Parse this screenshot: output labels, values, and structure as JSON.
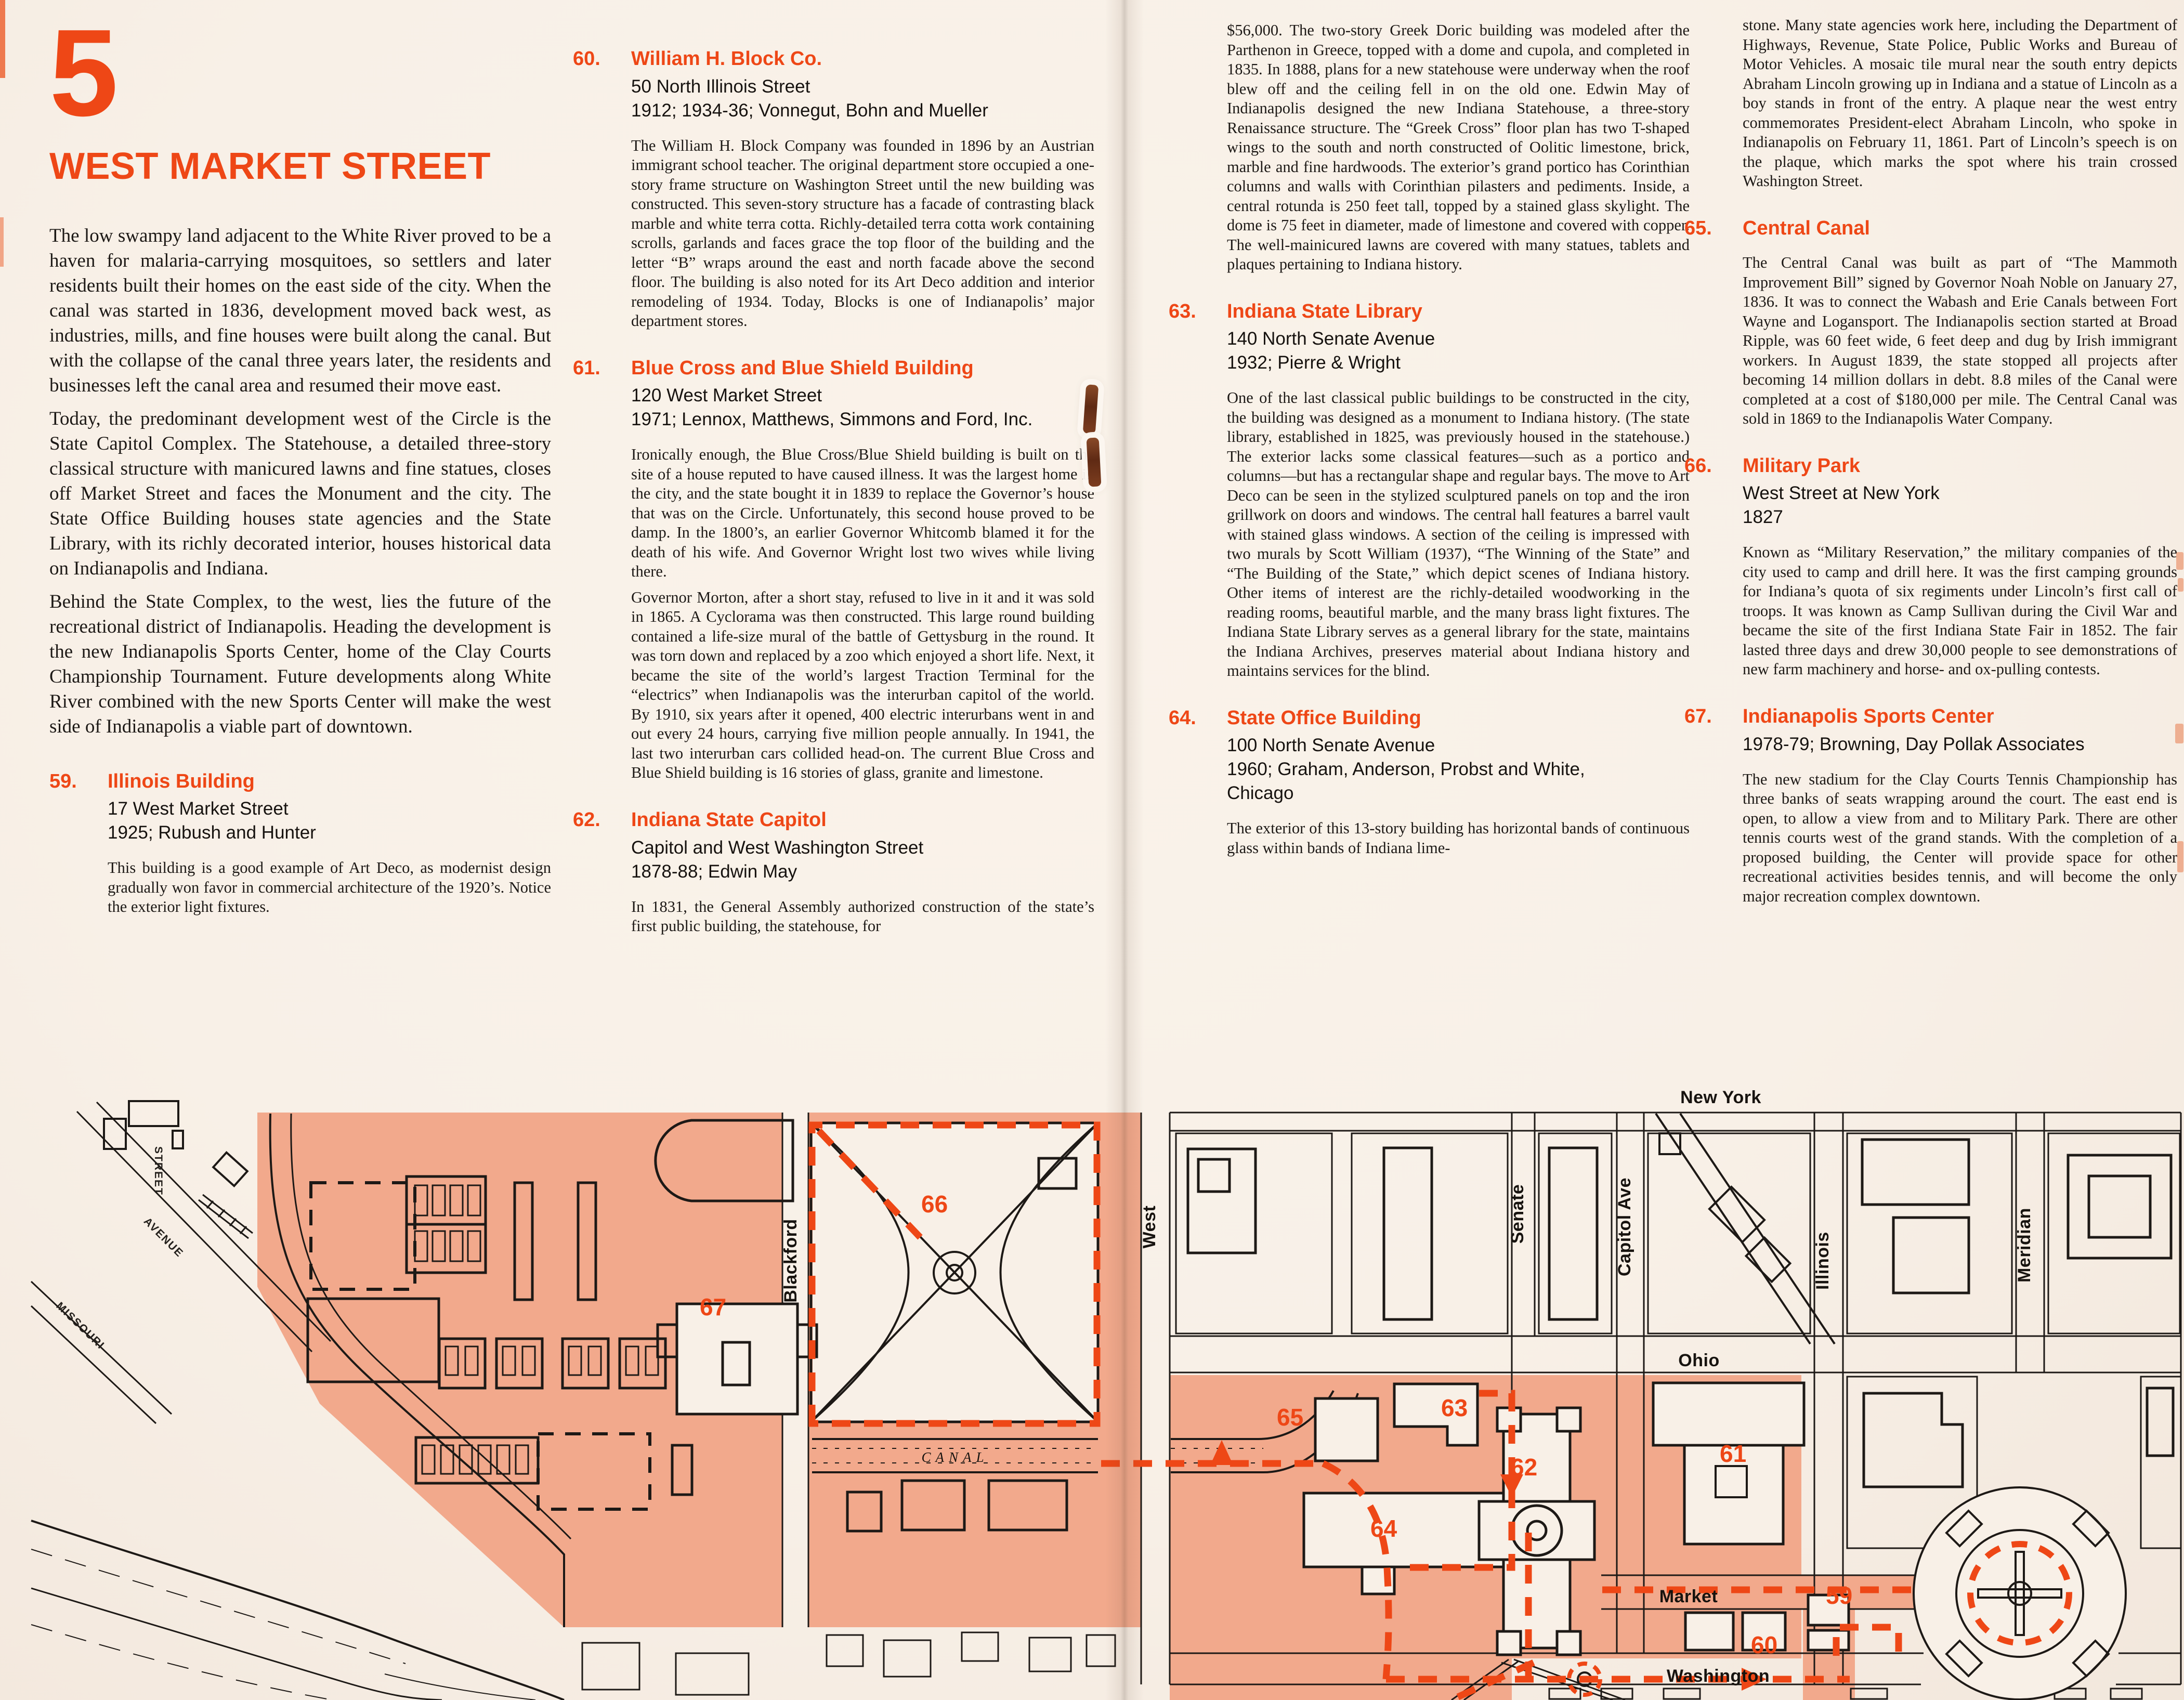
{
  "page": {
    "section_number": "5",
    "title": "WEST MARKET STREET",
    "accent_color": "#ee4716",
    "paper_color": "#f8f0e7",
    "map_shade_color": "#f2a98c"
  },
  "intro": {
    "paragraphs": [
      "The low swampy land adjacent to the White River proved to be a haven for malaria-carrying mosquitoes, so settlers and later residents built their homes on the east side of the city. When the canal was started in 1836, development moved back west, as industries, mills, and fine houses were built along the canal. But with the collapse of the canal three years later, the residents and businesses left the canal area and resumed their move east.",
      "Today, the predominant development west of the Circle is the State Capitol Complex. The Statehouse, a detailed three-story classical structure with manicured lawns and fine statues, closes off Market Street and faces the Monument and the city. The State Office Building houses state agencies and the State Library, with its richly decorated interior, houses historical data on Indianapolis and Indiana.",
      "Behind the State Complex, to the west, lies the future of the recreational district of Indianapolis. Heading the development is the new Indianapolis Sports Center, home of the Clay Courts Championship Tournament. Future developments along White River combined with the new Sports Center will make the west side of Indianapolis a viable part of downtown."
    ]
  },
  "entries": [
    {
      "id": "59",
      "number": "59.",
      "name": "Illinois Building",
      "address": [
        "17 West Market Street",
        "1925; Rubush and Hunter"
      ],
      "paragraphs": [
        "This building is a good example of Art Deco, as modernist design gradually won favor in commercial architecture of the 1920’s. Notice the exterior light fixtures."
      ]
    },
    {
      "id": "60",
      "number": "60.",
      "name": "William H. Block Co.",
      "address": [
        "50 North Illinois Street",
        "1912; 1934-36; Vonnegut, Bohn and Mueller"
      ],
      "paragraphs": [
        "The William H. Block Company was founded in 1896 by an Austrian immigrant school teacher. The original department store occupied a one-story frame structure on Washington Street until the new building was constructed. This seven-story structure has a facade of contrasting black marble and white terra cotta. Richly-detailed terra cotta work containing scrolls, garlands and faces grace the top floor of the building and the letter “B” wraps around the east and north facade above the second floor. The building is also noted for its Art Deco addition and interior remodeling of 1934. Today, Blocks is one of Indianapolis’ major department stores."
      ]
    },
    {
      "id": "61",
      "number": "61.",
      "name": "Blue Cross and Blue Shield Building",
      "address": [
        "120 West Market Street",
        "1971; Lennox, Matthews, Simmons and Ford, Inc."
      ],
      "paragraphs": [
        "Ironically enough, the Blue Cross/Blue Shield building is built on the site of a house reputed to have caused illness. It was the largest home in the city, and the state bought it in 1839 to replace the Governor’s house that was on the Circle. Unfortunately, this second house proved to be damp. In the 1800’s, an earlier Governor Whitcomb blamed it for the death of his wife. And Governor Wright lost two wives while living there.",
        "Governor Morton, after a short stay, refused to live in it and it was sold in 1865. A Cyclorama was then constructed. This large round building contained a life-size mural of the battle of Gettysburg in the round. It was torn down and replaced by a zoo which enjoyed a short life. Next, it became the site of the world’s largest Traction Terminal for the “electrics” when Indianapolis was the interurban capitol of the world. By 1910, six years after it opened, 400 electric interurbans went in and out every 24 hours, carrying five million people annually. In 1941, the last two interurban cars collided head-on. The current Blue Cross and Blue Shield building is 16 stories of glass, granite and limestone."
      ]
    },
    {
      "id": "62",
      "number": "62.",
      "name": "Indiana State Capitol",
      "address": [
        "Capitol and West Washington Street",
        "1878-88; Edwin May"
      ],
      "paragraphs": [
        "In 1831, the General Assembly authorized construction of the state’s first public building, the statehouse, for"
      ]
    },
    {
      "id": "63",
      "number": "63.",
      "name": "Indiana State Library",
      "address": [
        "140 North Senate Avenue",
        "1932; Pierre & Wright"
      ],
      "paragraphs": [
        "One of the last classical public buildings to be constructed in the city, the building was designed as a monument to Indiana history. (The state library, established in 1825, was previously housed in the statehouse.) The exterior lacks some classical features—such as a portico and columns—but has a rectangular shape and regular bays. The move to Art Deco can be seen in the stylized sculptured panels on top and the iron grillwork on doors and windows. The central hall features a barrel vault with stained glass windows. A section of the ceiling is impressed with two murals by Scott William (1937), “The Winning of the State” and “The Building of the State,” which depict scenes of Indiana history. Other items of interest are the richly-detailed woodworking in the reading rooms, beautiful marble, and the many brass light fixtures. The Indiana State Library serves as a general library for the state, maintains the Indiana Archives, preserves material about Indiana history and maintains services for the blind."
      ]
    },
    {
      "id": "64",
      "number": "64.",
      "name": "State Office Building",
      "address": [
        "100 North Senate Avenue",
        "1960; Graham, Anderson, Probst and White,",
        "Chicago"
      ],
      "paragraphs": [
        "The exterior of this 13-story building has horizontal bands of continuous glass within bands of Indiana lime-"
      ]
    },
    {
      "id": "65",
      "number": "65.",
      "name": "Central Canal",
      "address": [],
      "paragraphs": [
        "The Central Canal was built as part of “The Mammoth Improvement Bill” signed by Governor Noah Noble on January 27, 1836. It was to connect the Wabash and Erie Canals between Fort Wayne and Logansport. The Indianapolis section started at Broad Ripple, was 60 feet wide, 6 feet deep and dug by Irish immigrant workers. In August 1839, the state stopped all projects after becoming 14 million dollars in debt. 8.8 miles of the Canal were completed at a cost of $180,000 per mile. The Central Canal was sold in 1869 to the Indianapolis Water Company."
      ]
    },
    {
      "id": "66",
      "number": "66.",
      "name": "Military Park",
      "address": [
        "West Street at New York",
        "1827"
      ],
      "paragraphs": [
        "Known as “Military Reservation,” the military companies of the city used to camp and drill here. It was the first camping grounds for Indiana’s quota of six regiments under Lincoln’s first call of troops. It was known as Camp Sullivan during the Civil War and became the site of the first Indiana State Fair in 1852. The fair lasted three days and drew 30,000 people to see demonstrations of new farm machinery and horse- and ox-pulling contests."
      ]
    },
    {
      "id": "67",
      "number": "67.",
      "name": "Indianapolis Sports Center",
      "address": [
        "1978-79; Browning, Day Pollak Associates"
      ],
      "paragraphs": [
        "The new stadium for the Clay Courts Tennis Championship has three banks of seats wrapping around the court. The east end is open, to allow a view from and to Military Park. There are other tennis courts west of the grand stands. With the completion of a proposed building, the Center will provide space for other recreational activities besides tennis, and will become the only major recreation complex downtown."
      ]
    }
  ],
  "continuations": {
    "capitol_col3": "$56,000. The two-story Greek Doric building was modeled after the Parthenon in Greece, topped with a dome and cupola, and completed in 1835. In 1888, plans for a new statehouse were underway when the roof blew off and the ceiling fell in on the old one. Edwin May of Indianapolis designed the new Indiana Statehouse, a three-story Renaissance structure. The “Greek Cross” floor plan has two T-shaped wings to the south and north constructed of Oolitic limestone, brick, marble and fine hardwoods. The exterior’s grand portico has Corinthian columns and walls with Corinthian pilasters and pediments. Inside, a central rotunda is 250 feet tall, topped by a stained glass skylight. The dome is 75 feet in diameter, made of limestone and covered with copper. The well-mainicured lawns are covered with many statues, tablets and plaques pertaining to Indiana history.",
    "state_office_col4": "stone. Many state agencies work here, including the Department of Highways, Revenue, State Police, Public Works and Bureau of Motor Vehicles. A mosaic tile mural near the south entry depicts Abraham Lincoln growing up in Indiana and a statue of Lincoln as a boy stands in front of the entry. A plaque near the west entry commemorates President-elect Abraham Lincoln, who spoke in Indianapolis on February 11, 1861. Part of Lincoln’s speech is on the plaque, which marks the spot where his train crossed Washington Street."
  },
  "map": {
    "labels": {
      "blackford": "Blackford",
      "west": "West",
      "senate": "Senate",
      "capitol_ave": "Capitol Ave",
      "illinois": "Illinois",
      "meridian": "Meridian",
      "new_york": "New York",
      "ohio": "Ohio",
      "market": "Market",
      "washington": "Washington",
      "canal": "CANAL",
      "avenue": "AVENUE",
      "missouri": "MISSOURI",
      "street": "STREET"
    },
    "numbers": {
      "n59": "59",
      "n60": "60",
      "n61": "61",
      "n62": "62",
      "n63": "63",
      "n64": "64",
      "n65": "65",
      "n66": "66",
      "n67": "67"
    }
  }
}
